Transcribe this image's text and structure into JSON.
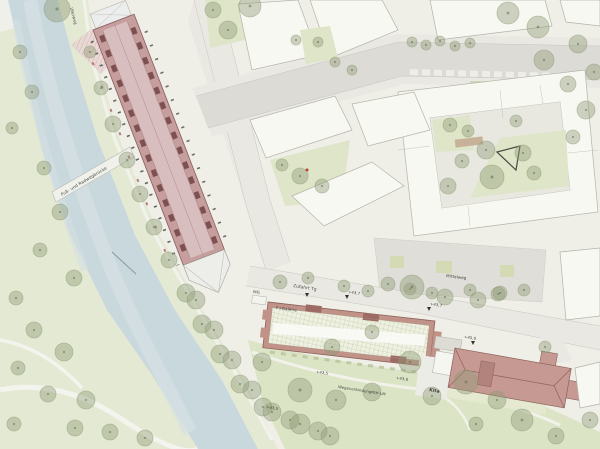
{
  "map": {
    "labels": {
      "bridge": "Fuß- und Radwegbrücke",
      "uferweg": "Uferweg",
      "mg": "MG",
      "zufahrt": "Zufahrt Tg",
      "galerie": "F+Galerie",
      "mittelweg": "Mittelweg",
      "kita": "Kita",
      "verbindung": "Wegeverbindung GH-LM",
      "elev_a": "+43,7",
      "elev_b": "+43,7",
      "elev_c": "+43,5",
      "elev_d": "+43,6",
      "elev_e": "+45,0",
      "elev_f": "+43,5"
    }
  },
  "colors": {
    "land": "#efefe8",
    "water": "#c9d8dd",
    "water_light": "#d6e1e3",
    "bank": "#e4e9d3",
    "park": "#dce4c6",
    "courtyard_green": "#dfe5c8",
    "tree": "#8f9c78",
    "tree_dark": "#5f6e4c",
    "road": "#dcdbd5",
    "street": "#e9e8e2",
    "building": "#f8f8f3",
    "outline": "#b3b3aa",
    "long_roof": "#c69e9e",
    "long_roof_light": "#d8bebe",
    "unit": "#7e5151",
    "grid_wall": "#c09288",
    "grid_line": "#b7c096",
    "kita_roof": "#c69a93",
    "roof_line": "#96655e",
    "plaza": "#dfded8"
  },
  "trees": [
    [
      57,
      9,
      13
    ],
    [
      20,
      52,
      7
    ],
    [
      32,
      92,
      7
    ],
    [
      12,
      128,
      6
    ],
    [
      44,
      168,
      7
    ],
    [
      60,
      212,
      8
    ],
    [
      40,
      250,
      7
    ],
    [
      74,
      278,
      8
    ],
    [
      16,
      298,
      7
    ],
    [
      34,
      330,
      8
    ],
    [
      64,
      352,
      9
    ],
    [
      18,
      368,
      7
    ],
    [
      48,
      394,
      8
    ],
    [
      86,
      400,
      9
    ],
    [
      14,
      424,
      7
    ],
    [
      75,
      428,
      8
    ],
    [
      110,
      432,
      8
    ],
    [
      145,
      438,
      8
    ],
    [
      90,
      52,
      6
    ],
    [
      101,
      88,
      7
    ],
    [
      113,
      124,
      8
    ],
    [
      127,
      160,
      8
    ],
    [
      140,
      194,
      8
    ],
    [
      154,
      227,
      8
    ],
    [
      169,
      260,
      8
    ],
    [
      186,
      293,
      9
    ],
    [
      202,
      324,
      9
    ],
    [
      220,
      354,
      9
    ],
    [
      240,
      384,
      9
    ],
    [
      263,
      407,
      9
    ],
    [
      290,
      420,
      9
    ],
    [
      318,
      431,
      9
    ],
    [
      196,
      300,
      9
    ],
    [
      214,
      330,
      9
    ],
    [
      232,
      360,
      9
    ],
    [
      252,
      390,
      9
    ],
    [
      272,
      412,
      9
    ],
    [
      300,
      424,
      10
    ],
    [
      330,
      436,
      9
    ],
    [
      213,
      10,
      8
    ],
    [
      228,
      30,
      9
    ],
    [
      250,
      6,
      11
    ],
    [
      296,
      40,
      5
    ],
    [
      318,
      42,
      5
    ],
    [
      335,
      62,
      5
    ],
    [
      352,
      70,
      5
    ],
    [
      412,
      42,
      5
    ],
    [
      426,
      45,
      5
    ],
    [
      440,
      41,
      5
    ],
    [
      455,
      46,
      5
    ],
    [
      470,
      43,
      5
    ],
    [
      508,
      13,
      11
    ],
    [
      538,
      27,
      11
    ],
    [
      544,
      60,
      10
    ],
    [
      578,
      44,
      9
    ],
    [
      594,
      72,
      8
    ],
    [
      568,
      84,
      8
    ],
    [
      586,
      110,
      9
    ],
    [
      573,
      137,
      7
    ],
    [
      450,
      125,
      7
    ],
    [
      468,
      131,
      6
    ],
    [
      486,
      150,
      9
    ],
    [
      462,
      161,
      7
    ],
    [
      448,
      186,
      8
    ],
    [
      492,
      177,
      12
    ],
    [
      523,
      153,
      8
    ],
    [
      534,
      173,
      7
    ],
    [
      516,
      121,
      6
    ],
    [
      300,
      176,
      8
    ],
    [
      322,
      186,
      7
    ],
    [
      282,
      165,
      6
    ],
    [
      388,
      284,
      7
    ],
    [
      410,
      289,
      6
    ],
    [
      432,
      293,
      6
    ],
    [
      470,
      290,
      6
    ],
    [
      498,
      294,
      7
    ],
    [
      524,
      290,
      6
    ],
    [
      280,
      282,
      7
    ],
    [
      308,
      278,
      6
    ],
    [
      344,
      286,
      6
    ],
    [
      368,
      291,
      6
    ],
    [
      412,
      287,
      12
    ],
    [
      445,
      297,
      8
    ],
    [
      478,
      300,
      8
    ],
    [
      500,
      293,
      7
    ],
    [
      262,
      362,
      9
    ],
    [
      300,
      390,
      12
    ],
    [
      336,
      400,
      10
    ],
    [
      372,
      392,
      9
    ],
    [
      410,
      362,
      11
    ],
    [
      432,
      396,
      9
    ],
    [
      466,
      382,
      12
    ],
    [
      332,
      347,
      8
    ],
    [
      372,
      332,
      7
    ],
    [
      497,
      400,
      9
    ],
    [
      522,
      420,
      11
    ],
    [
      556,
      436,
      8
    ],
    [
      476,
      424,
      7
    ],
    [
      590,
      420,
      8
    ],
    [
      545,
      347,
      6
    ]
  ]
}
